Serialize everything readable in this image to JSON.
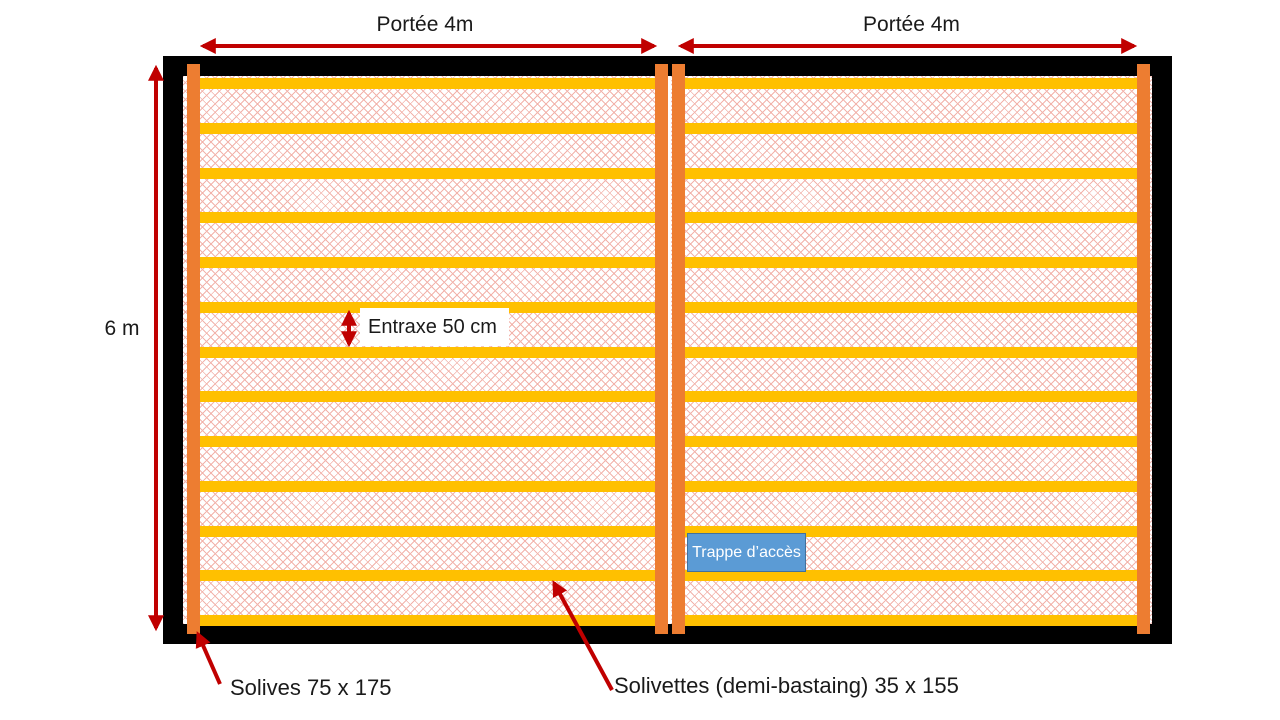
{
  "diagram": {
    "span_left_label": "Portée 4m",
    "span_right_label": "Portée 4m",
    "height_label": "6 m",
    "spacing_label": "Entraxe 50 cm",
    "access_hatch_label": "Trappe d’accès",
    "joist_label": "Solives 75 x 175",
    "subjoist_label": "Solivettes (demi-bastaing) 35 x 155"
  },
  "structure": {
    "spans": 2,
    "solivettes_per_span": 13,
    "solives_count": 4
  },
  "colors": {
    "arrow": "#C00000",
    "solive_beam": "#ED7D31",
    "solivette_bar": "#FFC000",
    "frame": "#000000",
    "trap_fill": "#5B9BD5",
    "trap_border": "#41719C",
    "hatch_line": "#F2B3AB",
    "text": "#1A1A1A"
  }
}
